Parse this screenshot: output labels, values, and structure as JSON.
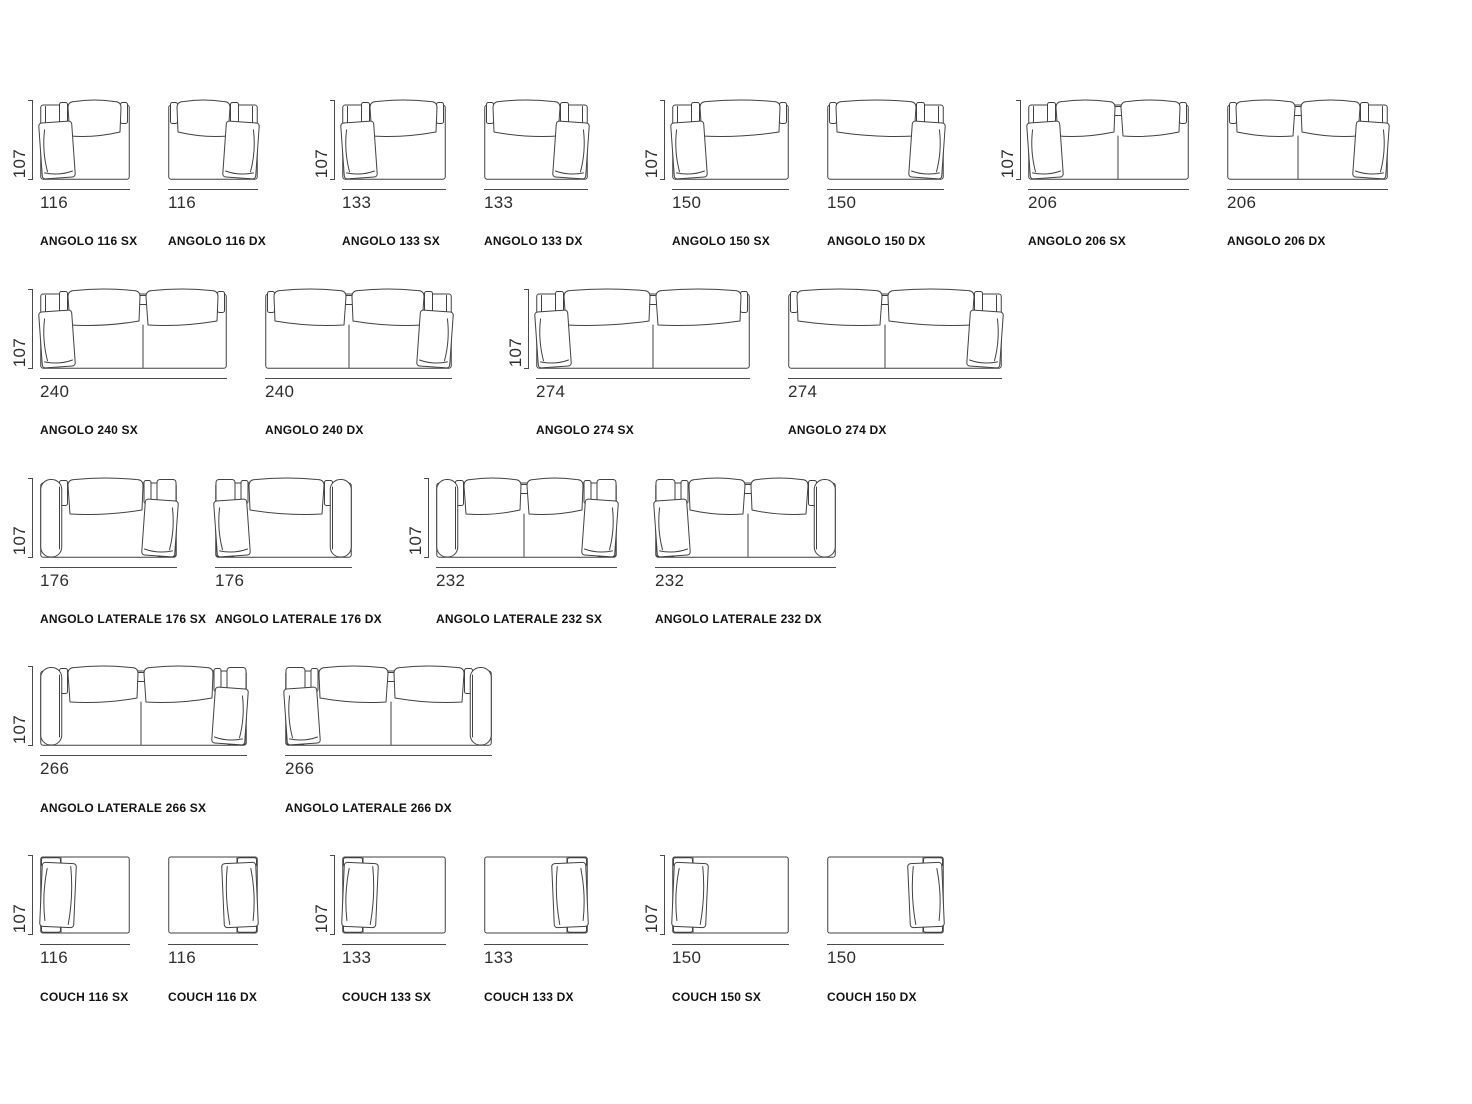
{
  "figure": {
    "sheet_name": "sofa-modules-dimension-sheet",
    "rows": [
      {
        "modules": [
          {
            "id": "angolo-116-sx",
            "label": "ANGOLO 116 SX",
            "width_label": "116",
            "height_label": "107",
            "width_cm": 116,
            "height_cm": 107,
            "type": "angolo",
            "seats": 1,
            "side": "SX",
            "show_height_dim": true
          },
          {
            "id": "angolo-116-dx",
            "label": "ANGOLO 116 DX",
            "width_label": "116",
            "width_cm": 116,
            "height_cm": 107,
            "type": "angolo",
            "seats": 1,
            "side": "DX",
            "show_height_dim": false
          },
          {
            "id": "angolo-133-sx",
            "label": "ANGOLO 133 SX",
            "width_label": "133",
            "height_label": "107",
            "width_cm": 133,
            "height_cm": 107,
            "type": "angolo",
            "seats": 1,
            "side": "SX",
            "show_height_dim": true
          },
          {
            "id": "angolo-133-dx",
            "label": "ANGOLO 133 DX",
            "width_label": "133",
            "width_cm": 133,
            "height_cm": 107,
            "type": "angolo",
            "seats": 1,
            "side": "DX",
            "show_height_dim": false
          },
          {
            "id": "angolo-150-sx",
            "label": "ANGOLO 150 SX",
            "width_label": "150",
            "height_label": "107",
            "width_cm": 150,
            "height_cm": 107,
            "type": "angolo",
            "seats": 1,
            "side": "SX",
            "show_height_dim": true
          },
          {
            "id": "angolo-150-dx",
            "label": "ANGOLO 150 DX",
            "width_label": "150",
            "width_cm": 150,
            "height_cm": 107,
            "type": "angolo",
            "seats": 1,
            "side": "DX",
            "show_height_dim": false
          },
          {
            "id": "angolo-206-sx",
            "label": "ANGOLO 206 SX",
            "width_label": "206",
            "height_label": "107",
            "width_cm": 206,
            "height_cm": 107,
            "type": "angolo",
            "seats": 2,
            "side": "SX",
            "show_height_dim": true
          },
          {
            "id": "angolo-206-dx",
            "label": "ANGOLO 206 DX",
            "width_label": "206",
            "width_cm": 206,
            "height_cm": 107,
            "type": "angolo",
            "seats": 2,
            "side": "DX",
            "show_height_dim": false
          }
        ]
      },
      {
        "modules": [
          {
            "id": "angolo-240-sx",
            "label": "ANGOLO 240 SX",
            "width_label": "240",
            "height_label": "107",
            "width_cm": 240,
            "height_cm": 107,
            "type": "angolo",
            "seats": 2,
            "side": "SX",
            "show_height_dim": true
          },
          {
            "id": "angolo-240-dx",
            "label": "ANGOLO 240 DX",
            "width_label": "240",
            "width_cm": 240,
            "height_cm": 107,
            "type": "angolo",
            "seats": 2,
            "side": "DX",
            "show_height_dim": false
          },
          {
            "id": "angolo-274-sx",
            "label": "ANGOLO 274 SX",
            "width_label": "274",
            "height_label": "107",
            "width_cm": 274,
            "height_cm": 107,
            "type": "angolo",
            "seats": 2,
            "side": "SX",
            "show_height_dim": true
          },
          {
            "id": "angolo-274-dx",
            "label": "ANGOLO 274 DX",
            "width_label": "274",
            "width_cm": 274,
            "height_cm": 107,
            "type": "angolo",
            "seats": 2,
            "side": "DX",
            "show_height_dim": false
          }
        ]
      },
      {
        "modules": [
          {
            "id": "angolo-laterale-176-sx",
            "label": "ANGOLO LATERALE 176 SX",
            "width_label": "176",
            "height_label": "107",
            "width_cm": 176,
            "height_cm": 107,
            "type": "laterale",
            "seats": 1,
            "side": "SX",
            "show_height_dim": true
          },
          {
            "id": "angolo-laterale-176-dx",
            "label": "ANGOLO LATERALE 176 DX",
            "width_label": "176",
            "width_cm": 176,
            "height_cm": 107,
            "type": "laterale",
            "seats": 1,
            "side": "DX",
            "show_height_dim": false
          },
          {
            "id": "angolo-laterale-232-sx",
            "label": "ANGOLO LATERALE 232 SX",
            "width_label": "232",
            "height_label": "107",
            "width_cm": 232,
            "height_cm": 107,
            "type": "laterale",
            "seats": 2,
            "side": "SX",
            "show_height_dim": true
          },
          {
            "id": "angolo-laterale-232-dx",
            "label": "ANGOLO LATERALE 232 DX",
            "width_label": "232",
            "width_cm": 232,
            "height_cm": 107,
            "type": "laterale",
            "seats": 2,
            "side": "DX",
            "show_height_dim": false
          }
        ]
      },
      {
        "modules": [
          {
            "id": "angolo-laterale-266-sx",
            "label": "ANGOLO LATERALE 266 SX",
            "width_label": "266",
            "height_label": "107",
            "width_cm": 266,
            "height_cm": 107,
            "type": "laterale",
            "seats": 2,
            "side": "SX",
            "show_height_dim": true
          },
          {
            "id": "angolo-laterale-266-dx",
            "label": "ANGOLO LATERALE 266 DX",
            "width_label": "266",
            "width_cm": 266,
            "height_cm": 107,
            "type": "laterale",
            "seats": 2,
            "side": "DX",
            "show_height_dim": false
          }
        ]
      },
      {
        "modules": [
          {
            "id": "couch-116-sx",
            "label": "COUCH 116 SX",
            "width_label": "116",
            "height_label": "107",
            "width_cm": 116,
            "height_cm": 107,
            "type": "couch",
            "seats": 1,
            "side": "SX",
            "show_height_dim": true
          },
          {
            "id": "couch-116-dx",
            "label": "COUCH 116 DX",
            "width_label": "116",
            "width_cm": 116,
            "height_cm": 107,
            "type": "couch",
            "seats": 1,
            "side": "DX",
            "show_height_dim": false
          },
          {
            "id": "couch-133-sx",
            "label": "COUCH 133 SX",
            "width_label": "133",
            "height_label": "107",
            "width_cm": 133,
            "height_cm": 107,
            "type": "couch",
            "seats": 1,
            "side": "SX",
            "show_height_dim": true
          },
          {
            "id": "couch-133-dx",
            "label": "COUCH 133 DX",
            "width_label": "133",
            "width_cm": 133,
            "height_cm": 107,
            "type": "couch",
            "seats": 1,
            "side": "DX",
            "show_height_dim": false
          },
          {
            "id": "couch-150-sx",
            "label": "COUCH 150 SX",
            "width_label": "150",
            "height_label": "107",
            "width_cm": 150,
            "height_cm": 107,
            "type": "couch",
            "seats": 1,
            "side": "SX",
            "show_height_dim": true
          },
          {
            "id": "couch-150-dx",
            "label": "COUCH 150 DX",
            "width_label": "150",
            "width_cm": 150,
            "height_cm": 107,
            "type": "couch",
            "seats": 1,
            "side": "DX",
            "show_height_dim": false
          }
        ]
      }
    ]
  },
  "colors": {
    "background": "#ffffff",
    "drawing_line": "#414141",
    "dimension_line": "#4a4a4a",
    "dimension_text": "#2e2e2e",
    "label_text": "#121212"
  }
}
